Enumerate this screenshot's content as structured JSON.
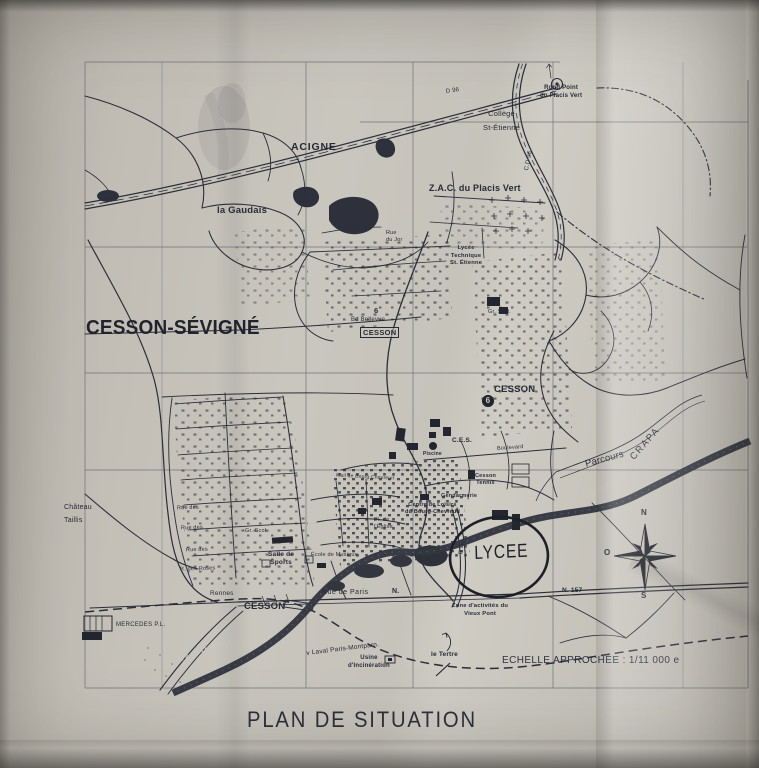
{
  "colors": {
    "paper": "#c6c2ba",
    "ink": "#2b2e3a"
  },
  "title": "PLAN DE SITUATION",
  "scale": "ECHELLE APPROCHÉE : 1/11 000 e",
  "compass": {
    "n": "N",
    "o": "O",
    "s": "S"
  },
  "labels": {
    "acigne": "ACIGNE",
    "rond_point": "Rond Point\ndu Placis Vert",
    "college": "Collège\nSt-Étienne",
    "d96_top": "D 96",
    "cd96": "C.D 96",
    "zac": "Z.A.C. du Placis Vert",
    "la_gaudais": "la Gaudais",
    "rue_du_jor": "Rue\ndu Jor",
    "lycee_technique": "Lycée\nTechnique\nSt. Étienne",
    "cesson_sevigne": "CESSON-SÉVIGNÉ",
    "bd_bellevue": "Bd Bellevue",
    "cesson_box": "CESSON",
    "bus_6": "6",
    "gr_scol_est": "Gr. Scol.",
    "cesson_est": "CESSON",
    "num_6": "6",
    "ces": "C.E.S.",
    "boulevard": "Boulevard",
    "piscine": "Piscine",
    "gendarmerie": "Gendarmerie",
    "cesson_tennis": "Cesson\nTennis",
    "centre_loisirs": "Centre de Loisirs\ndu Bourg-Chevreuil",
    "mail_bourg": "Mail de Bourg Chevreuil",
    "pl_eglise": "Pl. de\nl'Église",
    "gr_scol_ouest": "Gr. Scol.",
    "salle_sports": "Salle de\nSports",
    "ecole_musique": "École de Musique",
    "parcours": "Parcours",
    "crapa": "CRAPA",
    "vilaine_est": "LA VILAINE",
    "vilaine_ouest": "LA VILAINE",
    "lycee": "LYCEE",
    "d96_sud": "D 96",
    "rue_de_paris": "Rue de Paris",
    "n_abbr": "N.",
    "n157": "N. 157",
    "rennes": "Rennes",
    "cesson_gare": "CESSON",
    "zone_activites": "Zone d'activités du\nVieux Pont",
    "laval": "v Laval Paris-Montparn.",
    "usine": "Usine\nd'Incinération",
    "le_tertre": "le Tertre",
    "mercedes": "MERCEDES P.L.",
    "chateau_taillis": "Château\nTaillis",
    "rue_des_1": "Rue des",
    "rue_des_2": "Rue des",
    "rue_des_3": "Rue des",
    "rue_des_roses": "R. des Roses"
  }
}
